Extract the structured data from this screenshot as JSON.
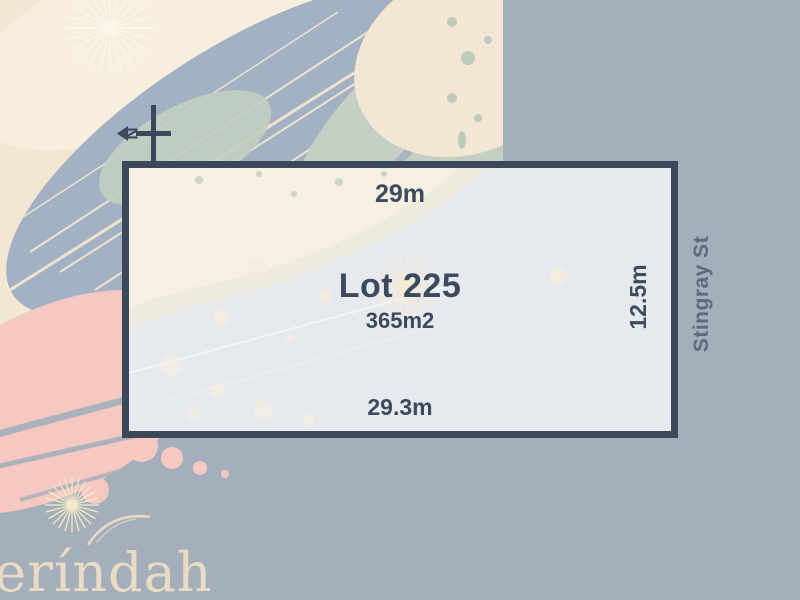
{
  "compass": {
    "north_label": "N"
  },
  "lot": {
    "title": "Lot 225",
    "area": "365m2",
    "top_dimension": "29m",
    "bottom_dimension": "29.3m",
    "right_dimension": "12.5m"
  },
  "street": {
    "name": "Stingray St"
  },
  "brand": {
    "wordmark": "meríndah"
  },
  "colors": {
    "background": "#a4afbb",
    "navy": "#3a4859",
    "lot_fill": "#e6eaee",
    "cream": "#f3e7d4",
    "sage": "#c5cfc3",
    "blue_feather": "#a2b2c4",
    "pink": "#f5c9c1",
    "street_text": "#5d6b7b",
    "brand_text": "#eadcc4"
  }
}
